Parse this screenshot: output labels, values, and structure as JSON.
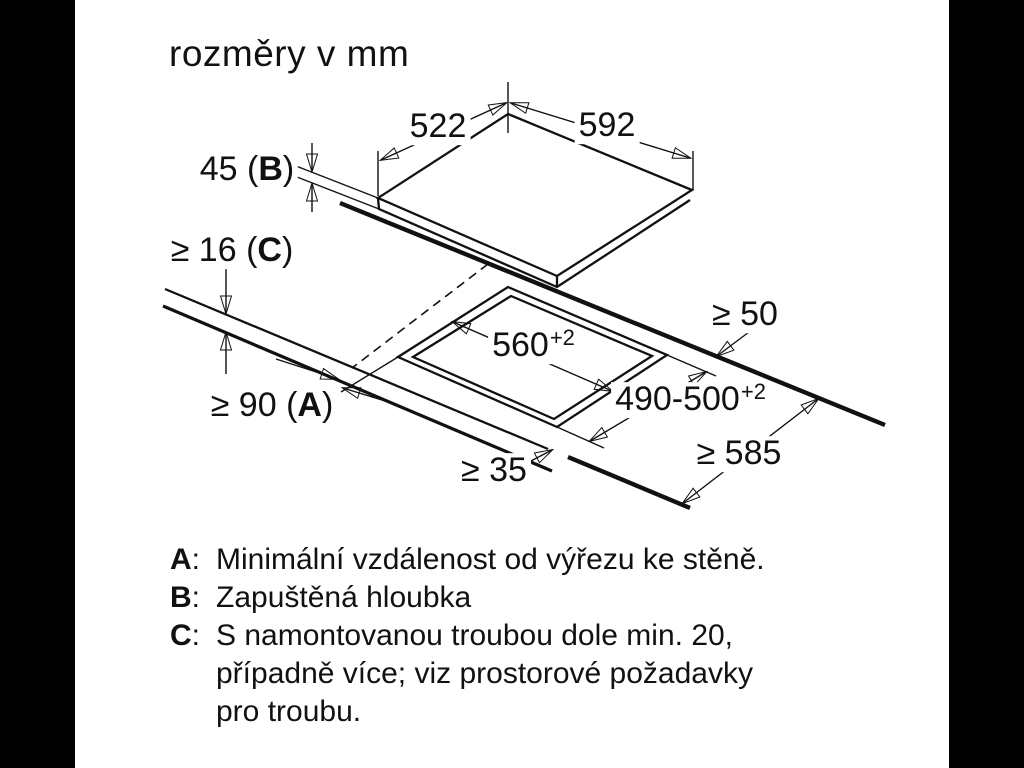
{
  "page": {
    "title": "rozměry v mm",
    "background": "#ffffff",
    "letterbox_color": "#000000",
    "line_color": "#111111"
  },
  "labels": {
    "hob_depth": "522",
    "hob_width": "592",
    "recess_depth": {
      "pre": "45 (",
      "key": "B",
      "post": ")"
    },
    "worktop_thickness": {
      "pre": "≥ 16 (",
      "key": "C",
      "post": ")"
    },
    "wall_clearance": {
      "pre": "≥ 90 (",
      "key": "A",
      "post": ")"
    },
    "cutout_width": {
      "value": "560",
      "sup": "+2"
    },
    "cutout_depth": {
      "value": "490-500",
      "sup": "+2"
    },
    "rear_clearance": "≥ 50",
    "worktop_depth": "≥ 585",
    "front_web": "≥ 35"
  },
  "notes": [
    {
      "key": "A",
      "sep": ":",
      "lines": [
        "Minimální vzdálenost od výřezu ke stěně."
      ]
    },
    {
      "key": "B",
      "sep": ":",
      "lines": [
        "Zapuštěná hloubka"
      ]
    },
    {
      "key": "C",
      "sep": ":",
      "lines": [
        "S namontovanou troubou dole min. 20,",
        "případně více; viz prostorové požadavky",
        "pro troubu."
      ]
    }
  ]
}
